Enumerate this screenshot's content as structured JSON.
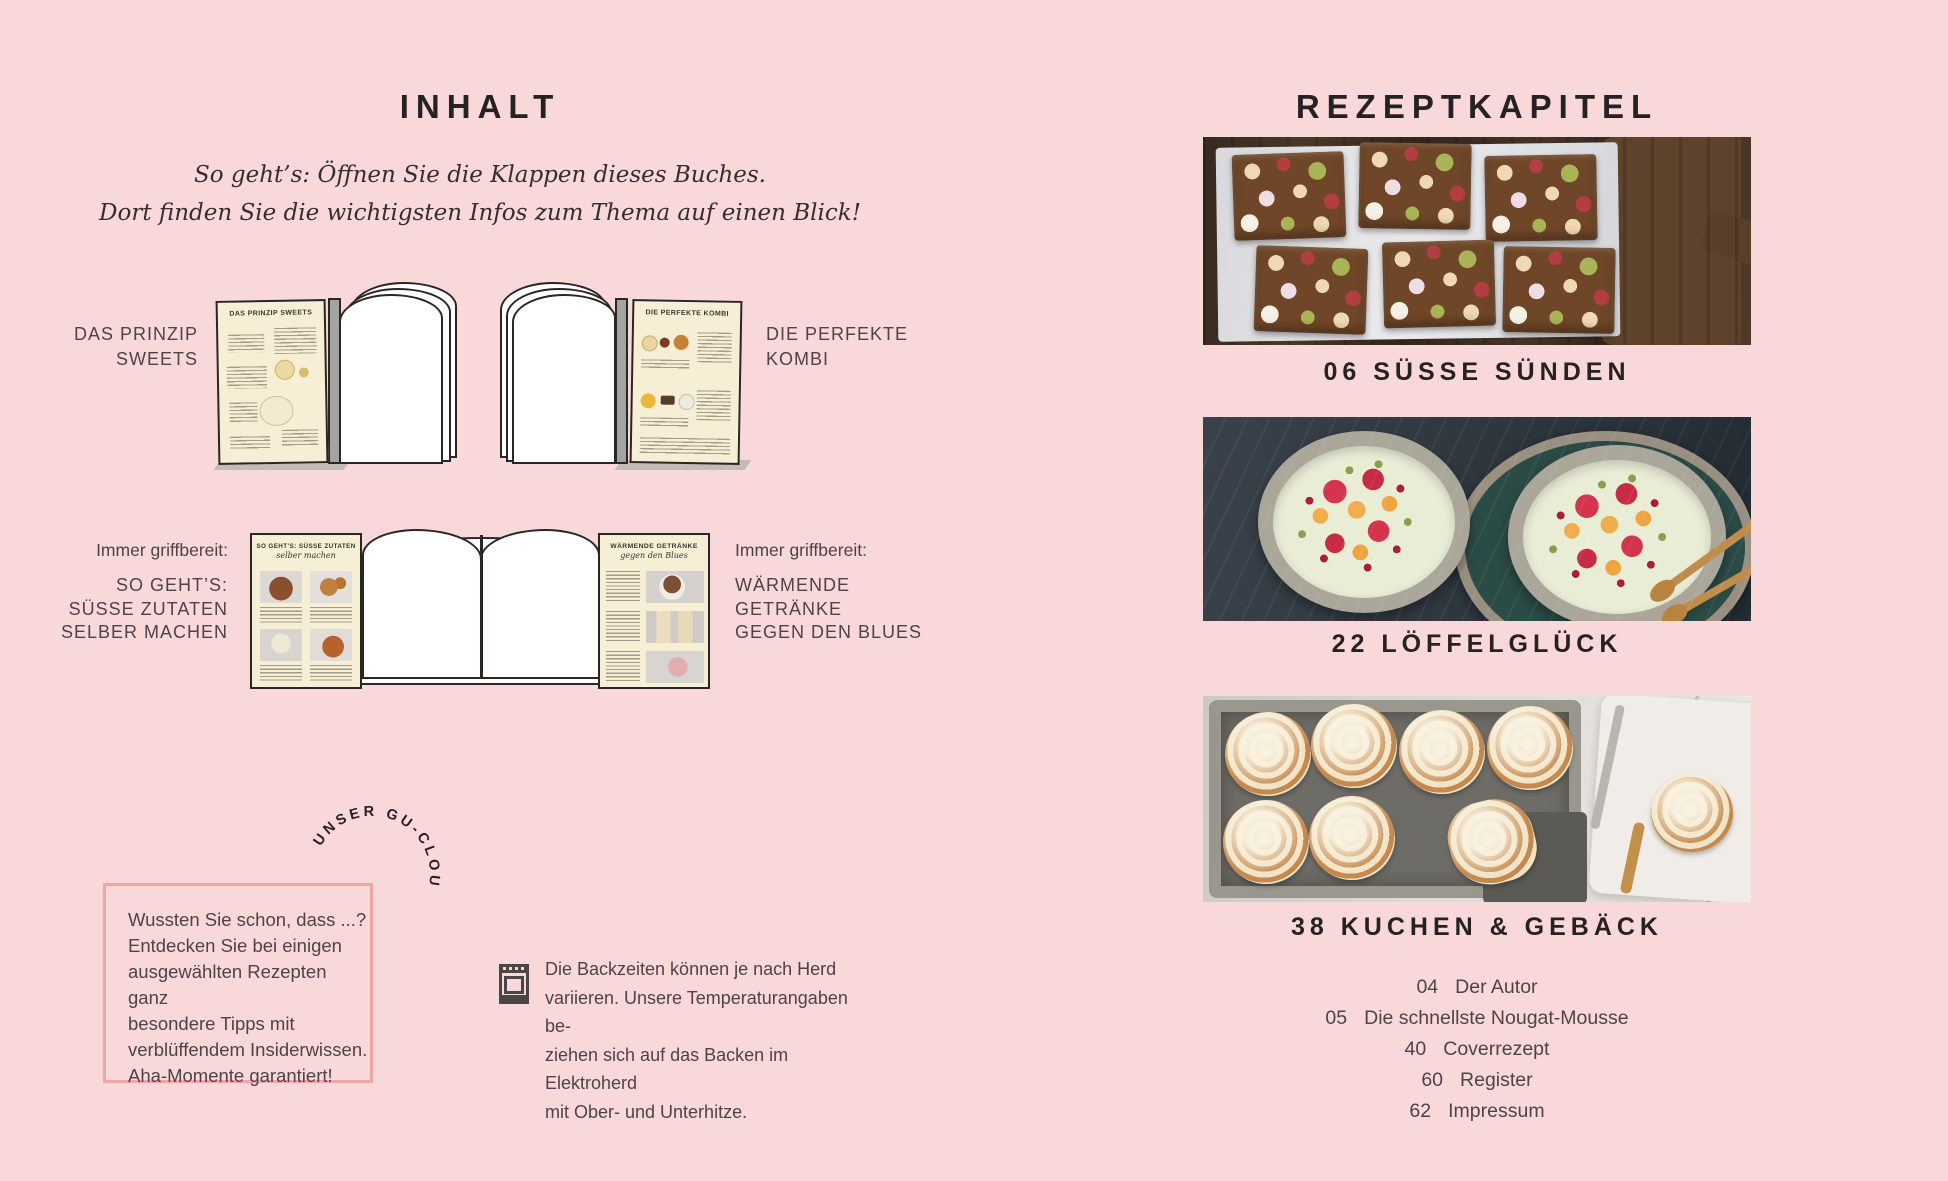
{
  "colors": {
    "background": "#f9d8da",
    "heading": "#262122",
    "body_text": "#4d4446",
    "tip_box_border": "#f0a6a5",
    "flap_cream": "#f6efd5",
    "outline_dark": "#2b2626"
  },
  "left_page": {
    "title": "INHALT",
    "intro": {
      "line1": "So geht’s: Öffnen Sie die Klappen dieses Buches.",
      "line2": "Dort finden Sie die wichtigsten Infos zum Thema auf einen Blick!"
    },
    "diagram_top_left": {
      "label_line1": "DAS PRINZIP",
      "label_line2": "SWEETS",
      "flap_title": "DAS PRINZIP SWEETS"
    },
    "diagram_top_right": {
      "label_line1": "DIE PERFEKTE",
      "label_line2": "KOMBI",
      "flap_title": "DIE PERFEKTE KOMBI"
    },
    "diagram_bottom": {
      "left_label_intro": "Immer griffbereit:",
      "left_label_line1": "SO GEHT’S:",
      "left_label_line2": "SÜSSE ZUTATEN",
      "left_label_line3": "SELBER MACHEN",
      "right_label_intro": "Immer griffbereit:",
      "right_label_line1": "WÄRMENDE",
      "right_label_line2": "GETRÄNKE",
      "right_label_line3": "GEGEN DEN BLUES",
      "flap_left_title": "SO GEHT’S: SÜSSE ZUTATEN",
      "flap_left_subtitle": "selber machen",
      "flap_right_title": "WÄRMENDE GETRÄNKE",
      "flap_right_subtitle": "gegen den Blues"
    },
    "badge_text": "UNSER GU-CLOU",
    "tip_box": {
      "line1": "Wussten Sie schon, dass ...?",
      "line2": "Entdecken Sie bei einigen",
      "line3": "ausgewählten Rezepten ganz",
      "line4": "besondere Tipps mit",
      "line5": "verblüffendem Insiderwissen.",
      "line6": "Aha-Momente garantiert!"
    },
    "oven_note": {
      "line1": "Die Backzeiten können je nach Herd",
      "line2": "variieren. Unsere Temperaturangaben be-",
      "line3": "ziehen sich auf das Backen im Elektroherd",
      "line4": "mit Ober- und Unterhitze."
    }
  },
  "right_page": {
    "title": "REZEPTKAPITEL",
    "chapters": [
      {
        "caption": "06 SÜSSE SÜNDEN",
        "photo_name": "rocky-road-chocolate-bars"
      },
      {
        "caption": "22 LÖFFELGLÜCK",
        "photo_name": "dessert-bowls-with-fruit"
      },
      {
        "caption": "38 KUCHEN & GEBÄCK",
        "photo_name": "cinnamon-rolls-in-pan"
      }
    ],
    "toc": [
      {
        "page": "04",
        "label": "Der Autor"
      },
      {
        "page": "05",
        "label": "Die schnellste Nougat-Mousse"
      },
      {
        "page": "40",
        "label": "Coverrezept"
      },
      {
        "page": "60",
        "label": "Register"
      },
      {
        "page": "62",
        "label": "Impressum"
      }
    ]
  }
}
